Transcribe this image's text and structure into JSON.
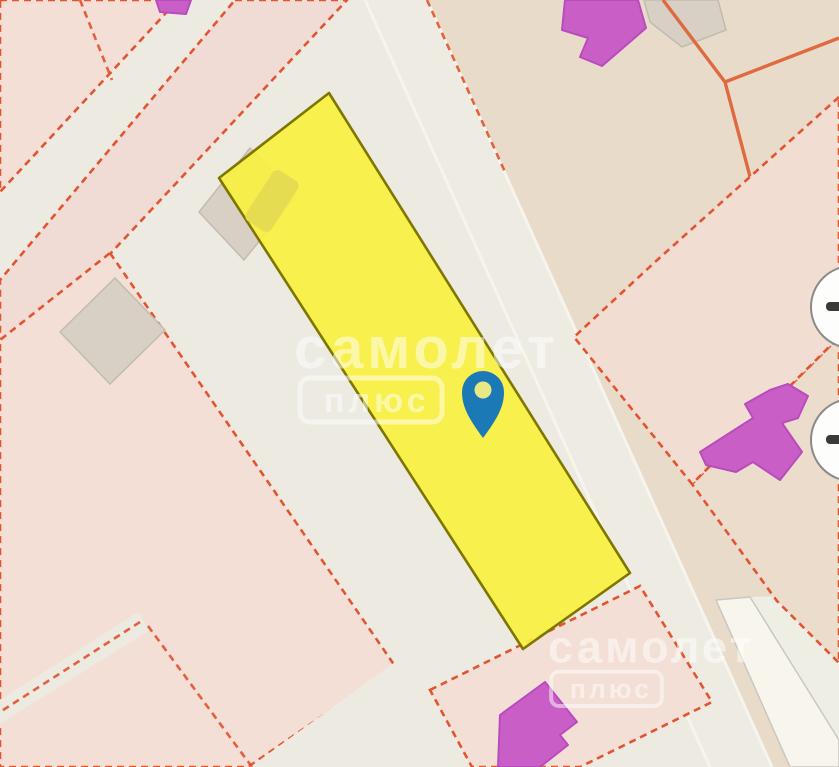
{
  "app": {
    "kind": "cadastral-map-viewer"
  },
  "watermarks": {
    "primary": {
      "brand": "самолет",
      "badge": "плюс"
    },
    "secondary": {
      "brand": "самолет",
      "badge": "плюс"
    }
  },
  "selected_parcel": {
    "fill": "#f8f040",
    "border": "#7e7600",
    "highlighted": "yes"
  },
  "pin": {
    "kind": "location-pin",
    "color": "#1b79b6",
    "hole_color": "#e8e887"
  },
  "controls": {
    "upper_button": {
      "icon": "dash",
      "partially_visible": "yes"
    },
    "lower_button": {
      "icon": "dash",
      "partially_visible": "yes"
    }
  },
  "colors": {
    "background": "#eceae1",
    "beige_area": "#e9dbca",
    "road": "#edebe2",
    "road_edge": "#f6f4ec",
    "white_road_band": "#f7f5ec",
    "parcel_pink": "#f3dfd6",
    "parcel_pink_right": "#f2ddd3",
    "parcel_border_dashed": "#e35531",
    "parcel_border_solid": "#e06a40",
    "selected_parcel_fill": "#f8f040",
    "selected_parcel_border": "#7e7600",
    "building_magenta": "#c95fc6",
    "building_magenta_border": "#b94cbc",
    "building_tan": "#d8d0c4",
    "pin_blue": "#1b79b6",
    "control_background": "#fdfdfc",
    "control_glyph": "#3a3a38",
    "watermark": "#ffffff"
  }
}
